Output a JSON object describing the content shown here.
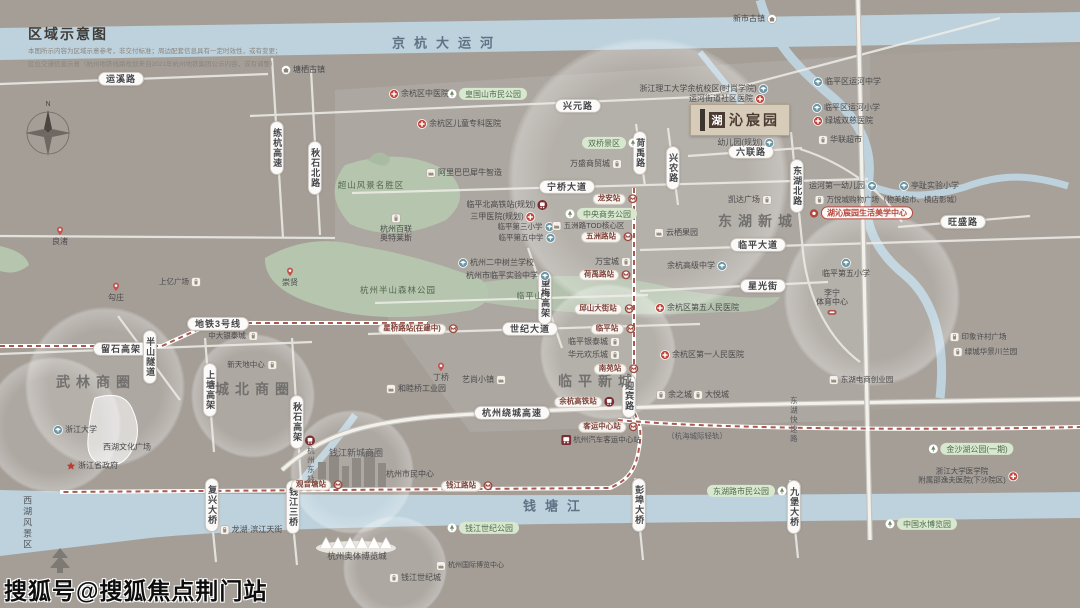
{
  "legend": {
    "title": "区域示意图",
    "disclaimer1": "本图所示内容为区域示意参考，非交付标准；周边配套信息具有一定时效性，或有变更；",
    "disclaimer2": "区位交通信息示意（杭州地铁线路规划来自2021年杭州地铁集团公示内容，或有调整）"
  },
  "watermark": "搜狐号@搜狐焦点荆门站",
  "project": {
    "logo_first_char": "湖",
    "logo_rest": "沁宸园",
    "full_name": "湖沁宸园"
  },
  "map": {
    "labels": [
      {
        "id": "road-yunxi",
        "t": "运溪路",
        "x": 121,
        "y": 79,
        "ty": "road"
      },
      {
        "id": "road-xingyuan",
        "t": "兴元路",
        "x": 578,
        "y": 106,
        "ty": "road"
      },
      {
        "id": "road-ningqiao",
        "t": "宁桥大道",
        "x": 567,
        "y": 187,
        "ty": "road"
      },
      {
        "id": "road-liulian",
        "t": "六联路",
        "x": 751,
        "y": 152,
        "ty": "road"
      },
      {
        "id": "road-linping-ave",
        "t": "临平大道",
        "x": 758,
        "y": 245,
        "ty": "road"
      },
      {
        "id": "road-xingguang",
        "t": "星光街",
        "x": 763,
        "y": 286,
        "ty": "road"
      },
      {
        "id": "road-wangsheng",
        "t": "旺盛路",
        "x": 963,
        "y": 222,
        "ty": "road"
      },
      {
        "id": "road-shiji-ave",
        "t": "世纪大道",
        "x": 530,
        "y": 329,
        "ty": "road"
      },
      {
        "id": "road-raocheng",
        "t": "杭州绕城高速",
        "x": 512,
        "y": 413,
        "ty": "road"
      },
      {
        "id": "road-liushi",
        "t": "留石高架",
        "x": 121,
        "y": 349,
        "ty": "road"
      },
      {
        "id": "metro-line3-tag",
        "t": "地铁3号线",
        "x": 218,
        "y": 324,
        "ty": "road",
        "fs": 7
      },
      {
        "id": "road-lianhang",
        "t": "练杭高速",
        "x": 277,
        "y": 148,
        "ty": "roadv",
        "v": 1
      },
      {
        "id": "road-qiushi-north",
        "t": "秋石北路",
        "x": 315,
        "y": 168,
        "ty": "roadv",
        "v": 1
      },
      {
        "id": "road-qiushi-viaduct",
        "t": "秋石高架",
        "x": 297,
        "y": 422,
        "ty": "roadv",
        "v": 1
      },
      {
        "id": "road-shangtang",
        "t": "上塘高架",
        "x": 210,
        "y": 390,
        "ty": "roadv",
        "v": 1
      },
      {
        "id": "road-banshan-tunnel",
        "t": "半山隧道",
        "x": 150,
        "y": 357,
        "ty": "roadv",
        "v": 1
      },
      {
        "id": "road-wangmei",
        "t": "望梅高架",
        "x": 545,
        "y": 298,
        "ty": "roadv",
        "v": 1
      },
      {
        "id": "road-heyu",
        "t": "荷禹路",
        "x": 640,
        "y": 153,
        "ty": "roadv",
        "v": 1
      },
      {
        "id": "road-xingnong",
        "t": "兴农路",
        "x": 673,
        "y": 168,
        "ty": "roadv",
        "v": 1,
        "fs": 7
      },
      {
        "id": "road-donghu-north",
        "t": "东湖北路",
        "x": 797,
        "y": 186,
        "ty": "roadv",
        "v": 1
      },
      {
        "id": "road-yingbin",
        "t": "迎宾路",
        "x": 629,
        "y": 396,
        "ty": "roadv",
        "v": 1,
        "fs": 6.5
      },
      {
        "id": "bridge-fuxing",
        "t": "复兴大桥",
        "x": 212,
        "y": 505,
        "ty": "roadv",
        "v": 1,
        "fs": 7
      },
      {
        "id": "bridge-qianjiang3",
        "t": "钱江三桥",
        "x": 293,
        "y": 507,
        "ty": "roadv",
        "v": 1,
        "fs": 7
      },
      {
        "id": "bridge-pengbu",
        "t": "彭埠大桥",
        "x": 639,
        "y": 505,
        "ty": "roadv",
        "v": 1,
        "fs": 7
      },
      {
        "id": "bridge-jiubao",
        "t": "九堡大桥",
        "x": 794,
        "y": 507,
        "ty": "roadv",
        "v": 1,
        "fs": 7
      },
      {
        "id": "road-donghu-express",
        "t": "东湖快速路",
        "x": 793,
        "y": 420,
        "ty": "note",
        "v": 1
      },
      {
        "id": "area-xihu-scenic",
        "t": "西湖风景区",
        "x": 27,
        "y": 523,
        "ty": "note",
        "v": 1,
        "fs": 9
      },
      {
        "id": "area-wulin",
        "t": "武林商圈",
        "x": 96,
        "y": 382,
        "ty": "area"
      },
      {
        "id": "area-chengbei",
        "t": "城北商圈",
        "x": 255,
        "y": 389,
        "ty": "area"
      },
      {
        "id": "area-donghu-newtown",
        "t": "东湖新城",
        "x": 758,
        "y": 221,
        "ty": "area"
      },
      {
        "id": "area-linping-newtown",
        "t": "临平新城",
        "x": 598,
        "y": 381,
        "ty": "area"
      },
      {
        "id": "area-qianjiang-cbd",
        "t": "钱江新城商圈",
        "x": 356,
        "y": 453,
        "ty": "note",
        "fs": 9
      },
      {
        "id": "river-grand-canal",
        "t": "京杭大运河",
        "x": 447,
        "y": 44,
        "ty": "water"
      },
      {
        "id": "river-qiantang",
        "t": "钱塘江",
        "x": 556,
        "y": 507,
        "ty": "water"
      },
      {
        "id": "rail-hanghai-note",
        "t": "（杭海城际轻轨）",
        "x": 697,
        "y": 437,
        "ty": "note"
      },
      {
        "id": "poi-tangqi-town",
        "t": "塘栖古镇",
        "x": 303,
        "y": 70,
        "icn": "town",
        "side": "l"
      },
      {
        "id": "poi-xinshi-town",
        "t": "新市古镇",
        "x": 755,
        "y": 19,
        "icn": "town",
        "side": "r"
      },
      {
        "id": "poi-yuhang-tcm-hospital",
        "t": "余杭区中医院",
        "x": 419,
        "y": 94,
        "icn": "hospital",
        "side": "l"
      },
      {
        "id": "poi-children-hospital",
        "t": "余杭区儿童专科医院",
        "x": 459,
        "y": 124,
        "icn": "hospital",
        "side": "l"
      },
      {
        "id": "poi-huangguoshan-park",
        "t": "皇国山市民公园",
        "x": 487,
        "y": 94,
        "ty": "gp",
        "icn": "tree",
        "side": "l"
      },
      {
        "id": "poi-alibaba-xiniu",
        "t": "阿里巴巴犀牛智造",
        "x": 464,
        "y": 173,
        "icn": "factory",
        "side": "l"
      },
      {
        "id": "poi-chaoshan-scenic",
        "t": "超山风景名胜区",
        "x": 371,
        "y": 186,
        "ty": "gt"
      },
      {
        "id": "poi-bailian-outlets",
        "t": "杭州百联\n奥特莱斯",
        "x": 396,
        "y": 228,
        "icn": "shop",
        "side": "t"
      },
      {
        "id": "poi-banshan-forest-park",
        "t": "杭州半山森林公园",
        "x": 398,
        "y": 291,
        "ty": "gt"
      },
      {
        "id": "poi-linpingshan",
        "t": "临平山",
        "x": 530,
        "y": 296,
        "ty": "gt",
        "fs": 8
      },
      {
        "id": "pin-chongxian",
        "t": "崇贤",
        "x": 290,
        "y": 277,
        "icn": "pin",
        "side": "t"
      },
      {
        "id": "pin-gouzhuang",
        "t": "勾庄",
        "x": 116,
        "y": 292,
        "icn": "pin",
        "side": "t"
      },
      {
        "id": "pin-liangzhu",
        "t": "良渚",
        "x": 60,
        "y": 236,
        "icn": "pin",
        "side": "t"
      },
      {
        "id": "pin-dingqiao",
        "t": "丁桥",
        "x": 441,
        "y": 372,
        "icn": "pin",
        "side": "t"
      },
      {
        "id": "poi-hz2-shulan-school",
        "t": "杭州二中树兰学校",
        "x": 496,
        "y": 263,
        "icn": "school",
        "side": "l"
      },
      {
        "id": "poi-linping-exp-school",
        "t": "杭州市临平实验中学",
        "x": 508,
        "y": 276,
        "icn": "school",
        "side": "r"
      },
      {
        "id": "sta-xingqiaolu",
        "t": "星桥路站(在建中)",
        "x": 418,
        "y": 329,
        "ty": "sta",
        "icn": "metro",
        "side": "r"
      },
      {
        "id": "poi-linpingbei-hsr",
        "t": "临平北高铁站(规划)",
        "x": 507,
        "y": 205,
        "icn": "rail",
        "side": "r"
      },
      {
        "id": "poi-3a-hospital-planned",
        "t": "三甲医院(规划)",
        "x": 503,
        "y": 217,
        "icn": "hospital",
        "side": "r"
      },
      {
        "id": "poi-linping-3rd-primary",
        "t": "临平第三小学",
        "x": 526,
        "y": 227,
        "icn": "school",
        "side": "r",
        "fs": 7.5
      },
      {
        "id": "poi-linping-5th-middle",
        "t": "临平第五中学",
        "x": 527,
        "y": 238,
        "icn": "school",
        "side": "r",
        "fs": 7.5
      },
      {
        "id": "poi-cbd-park",
        "t": "中央商务公园",
        "x": 601,
        "y": 214,
        "ty": "gp",
        "icn": "tree",
        "side": "l",
        "fs": 7.5
      },
      {
        "id": "poi-wuzhoulu-tod",
        "t": "五洲路TOD核心区",
        "x": 588,
        "y": 226,
        "icn": "factory",
        "side": "l",
        "fs": 7.5
      },
      {
        "id": "poi-wansheng-mall",
        "t": "万盛商贸城",
        "x": 596,
        "y": 164,
        "icn": "shop",
        "side": "r"
      },
      {
        "id": "poi-shuangqiao-scenic",
        "t": "双桥景区",
        "x": 610,
        "y": 143,
        "ty": "gp",
        "icn": "tree",
        "side": "r",
        "fs": 7.5
      },
      {
        "id": "poi-yunqi-orchard",
        "t": "云栖果园",
        "x": 676,
        "y": 233,
        "icn": "factory",
        "side": "l"
      },
      {
        "id": "poi-wanbaocheng",
        "t": "万宝城",
        "x": 613,
        "y": 262,
        "icn": "shop",
        "side": "r"
      },
      {
        "id": "poi-kaida-plaza",
        "t": "凯达广场",
        "x": 750,
        "y": 200,
        "icn": "shop",
        "side": "r"
      },
      {
        "id": "poi-yuhang-senior-high",
        "t": "余杭高级中学",
        "x": 697,
        "y": 266,
        "icn": "school",
        "side": "r"
      },
      {
        "id": "poi-5th-people-hospital",
        "t": "余杭区第五人民医院",
        "x": 697,
        "y": 308,
        "icn": "hospital",
        "side": "l"
      },
      {
        "id": "poi-1st-people-hospital",
        "t": "余杭区第一人民医院",
        "x": 702,
        "y": 355,
        "icn": "hospital",
        "side": "l"
      },
      {
        "id": "poi-intime-city",
        "t": "临平银泰城",
        "x": 594,
        "y": 342,
        "icn": "shop",
        "side": "r"
      },
      {
        "id": "poi-huayuan-happycity",
        "t": "华元欢乐城",
        "x": 594,
        "y": 355,
        "icn": "shop",
        "side": "r"
      },
      {
        "id": "poi-yuzhicheng",
        "t": "余之城",
        "x": 674,
        "y": 395,
        "icn": "shop",
        "side": "l"
      },
      {
        "id": "poi-dayuecheng",
        "t": "大悦城",
        "x": 711,
        "y": 395,
        "icn": "shop",
        "side": "l"
      },
      {
        "id": "poi-hemuqiao-industrial",
        "t": "和睦桥工业园",
        "x": 416,
        "y": 389,
        "icn": "factory",
        "side": "l"
      },
      {
        "id": "poi-yishang-town",
        "t": "艺尚小镇",
        "x": 484,
        "y": 380,
        "icn": "factory",
        "side": "r"
      },
      {
        "id": "poi-zstu-campus",
        "t": "浙江理工大学余杭校区(时尚学院)",
        "x": 704,
        "y": 89,
        "icn": "school",
        "side": "r"
      },
      {
        "id": "poi-yunhe-community-hospital",
        "t": "运河街道社区医院",
        "x": 727,
        "y": 99,
        "icn": "hospital",
        "side": "r"
      },
      {
        "id": "poi-kindergarten-planned",
        "t": "幼儿园(规划)",
        "x": 746,
        "y": 143,
        "icn": "school",
        "side": "r"
      },
      {
        "id": "poi-life-aesthetics-center",
        "t": "湖沁宸园生活美学中心",
        "x": 861,
        "y": 213,
        "ty": "center",
        "icn": "dot",
        "side": "l"
      },
      {
        "id": "poi-yunhe-1st-kindergarten",
        "t": "运河第一幼儿园",
        "x": 843,
        "y": 186,
        "icn": "school",
        "side": "r"
      },
      {
        "id": "poi-tingzhi-primary",
        "t": "亭趾实验小学",
        "x": 929,
        "y": 186,
        "icn": "school",
        "side": "l"
      },
      {
        "id": "poi-wanyuecheng-mall",
        "t": "万悦城购物广场（物美超市、横店影城）",
        "x": 888,
        "y": 200,
        "icn": "shop",
        "side": "l",
        "fs": 7.5
      },
      {
        "id": "poi-yunhe-middle",
        "t": "临平区运河中学",
        "x": 847,
        "y": 82,
        "icn": "school",
        "side": "l"
      },
      {
        "id": "poi-yunhe-primary",
        "t": "临平区运河小学",
        "x": 846,
        "y": 108,
        "icn": "school",
        "side": "l"
      },
      {
        "id": "poi-lvcheng-hospital",
        "t": "绿城双慈医院",
        "x": 843,
        "y": 121,
        "icn": "hospital",
        "side": "l"
      },
      {
        "id": "poi-hualian-market",
        "t": "华联超市",
        "x": 840,
        "y": 140,
        "icn": "shop",
        "side": "l"
      },
      {
        "id": "poi-linping-5th-primary",
        "t": "临平第五小学",
        "x": 846,
        "y": 268,
        "icn": "school",
        "side": "t"
      },
      {
        "id": "poi-lining-sports",
        "t": "李宁\n体育中心",
        "x": 832,
        "y": 303,
        "icn": "stadium",
        "side": "b"
      },
      {
        "id": "poi-yinxiang-xucun",
        "t": "印象许村广场",
        "x": 978,
        "y": 337,
        "icn": "shop",
        "side": "l",
        "fs": 7.5
      },
      {
        "id": "poi-lvcheng-lanyuan",
        "t": "绿城华景川兰园",
        "x": 985,
        "y": 352,
        "icn": "shop",
        "side": "l",
        "fs": 7.5
      },
      {
        "id": "poi-donghu-ecommerce",
        "t": "东湖电商创业园",
        "x": 861,
        "y": 380,
        "icn": "factory",
        "side": "l",
        "fs": 7.5
      },
      {
        "id": "poi-zhejiang-university",
        "t": "浙江大学",
        "x": 75,
        "y": 430,
        "icn": "school",
        "side": "l"
      },
      {
        "id": "poi-xihu-culture-square",
        "t": "西湖文化广场",
        "x": 127,
        "y": 447
      },
      {
        "id": "poi-provincial-gov",
        "t": "浙江省政府",
        "x": 92,
        "y": 466,
        "icn": "star",
        "side": "l"
      },
      {
        "id": "poi-shangyi-plaza",
        "t": "上亿广场",
        "x": 180,
        "y": 282,
        "icn": "shop",
        "side": "r",
        "fs": 7.5
      },
      {
        "id": "poi-zhongda-intime",
        "t": "中大银泰城",
        "x": 233,
        "y": 336,
        "icn": "shop",
        "side": "r",
        "fs": 7.5
      },
      {
        "id": "poi-xintiandi-center",
        "t": "新天地中心",
        "x": 252,
        "y": 365,
        "icn": "shop",
        "side": "r",
        "fs": 7.5
      },
      {
        "id": "poi-longfor-binjiang",
        "t": "龙湖·滨江天街",
        "x": 251,
        "y": 530,
        "icn": "shop",
        "side": "l"
      },
      {
        "id": "poi-citizen-center",
        "t": "杭州市民中心",
        "x": 410,
        "y": 474
      },
      {
        "id": "sta-qianjianglu",
        "t": "钱江路站",
        "x": 467,
        "y": 486,
        "ty": "sta",
        "icn": "metro",
        "side": "r"
      },
      {
        "id": "sta-guanyintang",
        "t": "观音塘站",
        "x": 317,
        "y": 485,
        "ty": "sta",
        "icn": "metro",
        "side": "r"
      },
      {
        "id": "sta-keyun-center",
        "t": "客运中心站",
        "x": 608,
        "y": 427,
        "ty": "sta",
        "icn": "metro",
        "side": "r"
      },
      {
        "id": "poi-bus-terminal",
        "t": "杭州汽车客运中心站",
        "x": 601,
        "y": 440,
        "icn": "bus",
        "side": "l",
        "fs": 7.5
      },
      {
        "id": "sta-yuhang-hsr",
        "t": "余杭高铁站",
        "x": 584,
        "y": 402,
        "ty": "sta",
        "icn": "rail",
        "side": "r"
      },
      {
        "id": "sta-hangzhou-east",
        "t": "杭州东站",
        "x": 310,
        "y": 460,
        "ty": "note",
        "icn": "rail",
        "side": "t",
        "v": 1
      },
      {
        "id": "poi-aoti-expo",
        "t": "杭州奥体博览城",
        "x": 357,
        "y": 557,
        "fs": 8.5
      },
      {
        "id": "poi-qianjiang-century-city",
        "t": "钱江世纪城",
        "x": 415,
        "y": 578,
        "icn": "shop",
        "side": "l",
        "fs": 8
      },
      {
        "id": "poi-intl-expo-center",
        "t": "杭州国际博览中心",
        "x": 470,
        "y": 566,
        "icn": "factory",
        "side": "l",
        "fs": 7
      },
      {
        "id": "poi-qianjiang-century-park",
        "t": "钱江世纪公园",
        "x": 483,
        "y": 528,
        "ty": "gp",
        "icn": "tree",
        "side": "l"
      },
      {
        "id": "poi-jinshahu-park",
        "t": "金沙湖公园(一期)",
        "x": 971,
        "y": 449,
        "ty": "gp",
        "icn": "tree",
        "side": "l"
      },
      {
        "id": "poi-srrsh-hospital",
        "t": "浙江大学医学院\n附属邵逸夫医院(下沙院区)",
        "x": 968,
        "y": 476,
        "icn": "hospital",
        "side": "r",
        "fs": 7.5
      },
      {
        "id": "poi-water-expo-park",
        "t": "中国水博览园",
        "x": 921,
        "y": 524,
        "ty": "gp",
        "icn": "tree",
        "side": "l"
      },
      {
        "id": "poi-donghulu-citizen-park",
        "t": "东湖路市民公园",
        "x": 747,
        "y": 491,
        "ty": "gp",
        "icn": "tree",
        "side": "r"
      },
      {
        "id": "sta-longan",
        "t": "龙安站",
        "x": 615,
        "y": 199,
        "ty": "sta",
        "icn": "metro",
        "side": "r"
      },
      {
        "id": "sta-wuzhoulu",
        "t": "五洲路站",
        "x": 607,
        "y": 237,
        "ty": "sta",
        "icn": "metro",
        "side": "r"
      },
      {
        "id": "sta-heyulu",
        "t": "荷禹路站",
        "x": 605,
        "y": 275,
        "ty": "sta",
        "icn": "metro",
        "side": "r"
      },
      {
        "id": "sta-qiushan-street",
        "t": "邱山大街站",
        "x": 604,
        "y": 309,
        "ty": "sta",
        "icn": "metro",
        "side": "r"
      },
      {
        "id": "sta-linping",
        "t": "临平站",
        "x": 613,
        "y": 329,
        "ty": "sta",
        "icn": "metro",
        "side": "r"
      },
      {
        "id": "sta-nanyuan",
        "t": "南苑站",
        "x": 616,
        "y": 369,
        "ty": "sta",
        "icn": "metro",
        "side": "r"
      }
    ]
  }
}
